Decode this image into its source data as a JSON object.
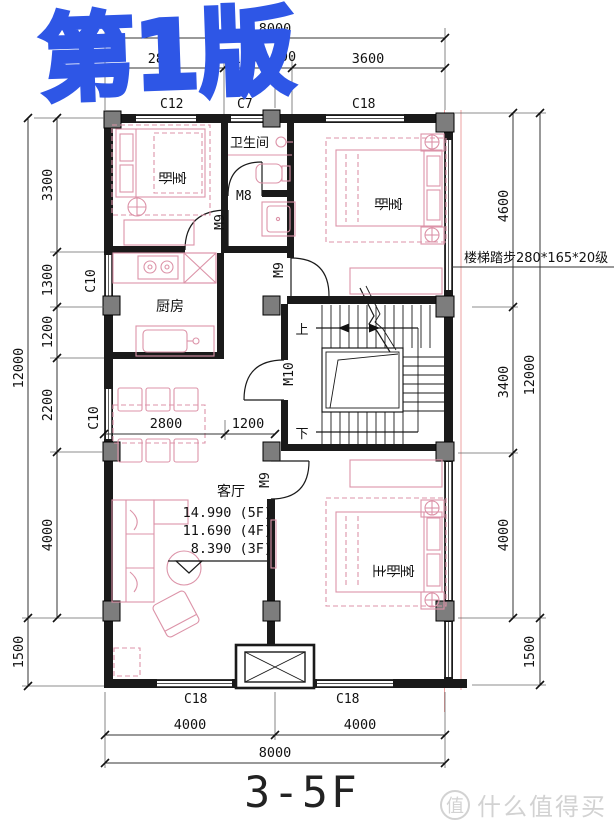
{
  "edition_watermark": "第1版",
  "sheet_title": "3-5F",
  "site_watermark": {
    "badge": "值",
    "text": "什么值得买"
  },
  "rooms": {
    "bedroom_top_left": "卧室",
    "bathroom": "卫生间",
    "bedroom_top_right": "卧室",
    "kitchen": "厨房",
    "living_room": "客厅",
    "master_bedroom": "主卧室"
  },
  "doors": {
    "m8": "M8",
    "m9": "M9",
    "m10": "M10"
  },
  "windows": {
    "c12": "C12",
    "c7": "C7",
    "c18": "C18",
    "c10": "C10"
  },
  "stairs": {
    "up": "上",
    "down": "下",
    "note": "楼梯踏步280*165*20级"
  },
  "elevations": [
    "14.990 (5F)",
    "11.690 (4F)",
    "8.390 (3F)"
  ],
  "dims": {
    "top": {
      "overall": "8000",
      "segments": [
        "2800",
        "1200",
        "400",
        "3600"
      ]
    },
    "bottom": {
      "overall": "8000",
      "segments": [
        "4000",
        "4000"
      ]
    },
    "left": {
      "overall": "12000",
      "segments": [
        "3300",
        "1300",
        "1200",
        "2200",
        "4000"
      ],
      "porch": "1500"
    },
    "right": {
      "overall": "12000",
      "segments": [
        "4600",
        "3400",
        "4000"
      ],
      "porch": "1500"
    },
    "interior": [
      "2800",
      "1200"
    ]
  },
  "colors": {
    "wall": "#1a1a1a",
    "furniture_pink": "#dc93a8",
    "column_gray": "#7d7d7d",
    "edition_blue": "#2e56e6",
    "site_gray": "#d2d2d2",
    "axis_red": "#eda0a0"
  }
}
